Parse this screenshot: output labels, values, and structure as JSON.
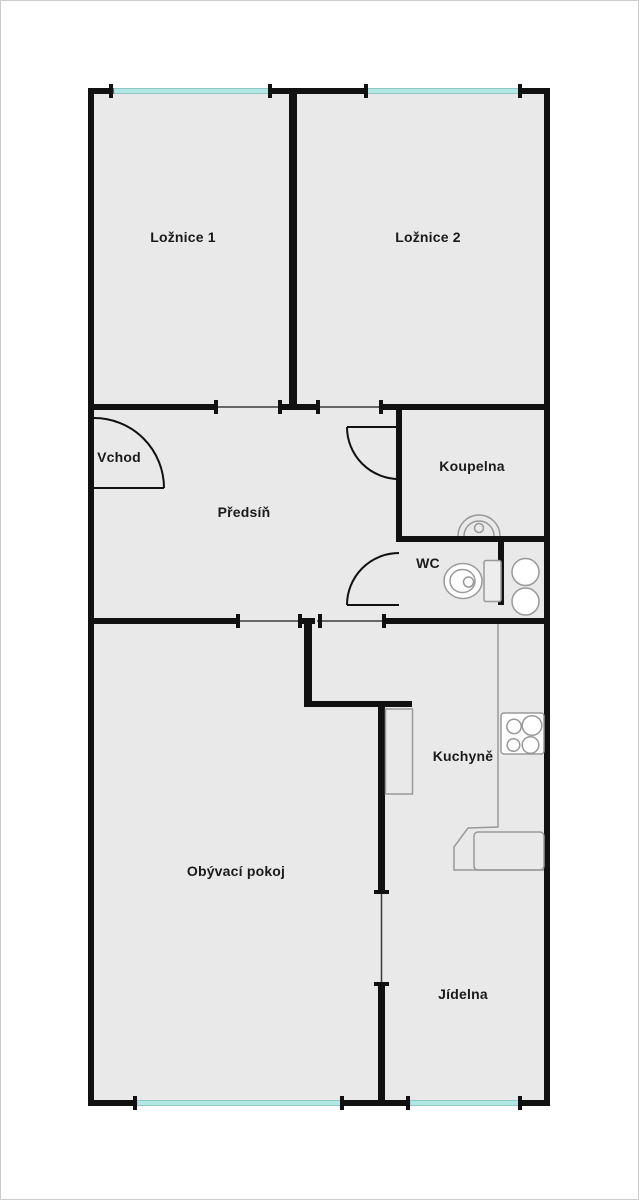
{
  "rooms": [
    {
      "id": "loznice-1",
      "label": "Ložnice 1"
    },
    {
      "id": "loznice-2",
      "label": "Ložnice 2"
    },
    {
      "id": "vchod",
      "label": "Vchod"
    },
    {
      "id": "predsin",
      "label": "Předsíň"
    },
    {
      "id": "koupelna",
      "label": "Koupelna"
    },
    {
      "id": "wc",
      "label": "WC"
    },
    {
      "id": "kuchyne",
      "label": "Kuchyně"
    },
    {
      "id": "obyvaci-pokoj",
      "label": "Obývací pokoj"
    },
    {
      "id": "jidelna",
      "label": "Jídelna"
    }
  ],
  "colors": {
    "background": "#ffffff",
    "canvas_border": "#cccccc",
    "floor": "#e9e9e9",
    "wall": "#111111",
    "window_glass": "#b2e7e3",
    "fixture_outline": "#999999",
    "label_text": "#1a1a1a"
  }
}
